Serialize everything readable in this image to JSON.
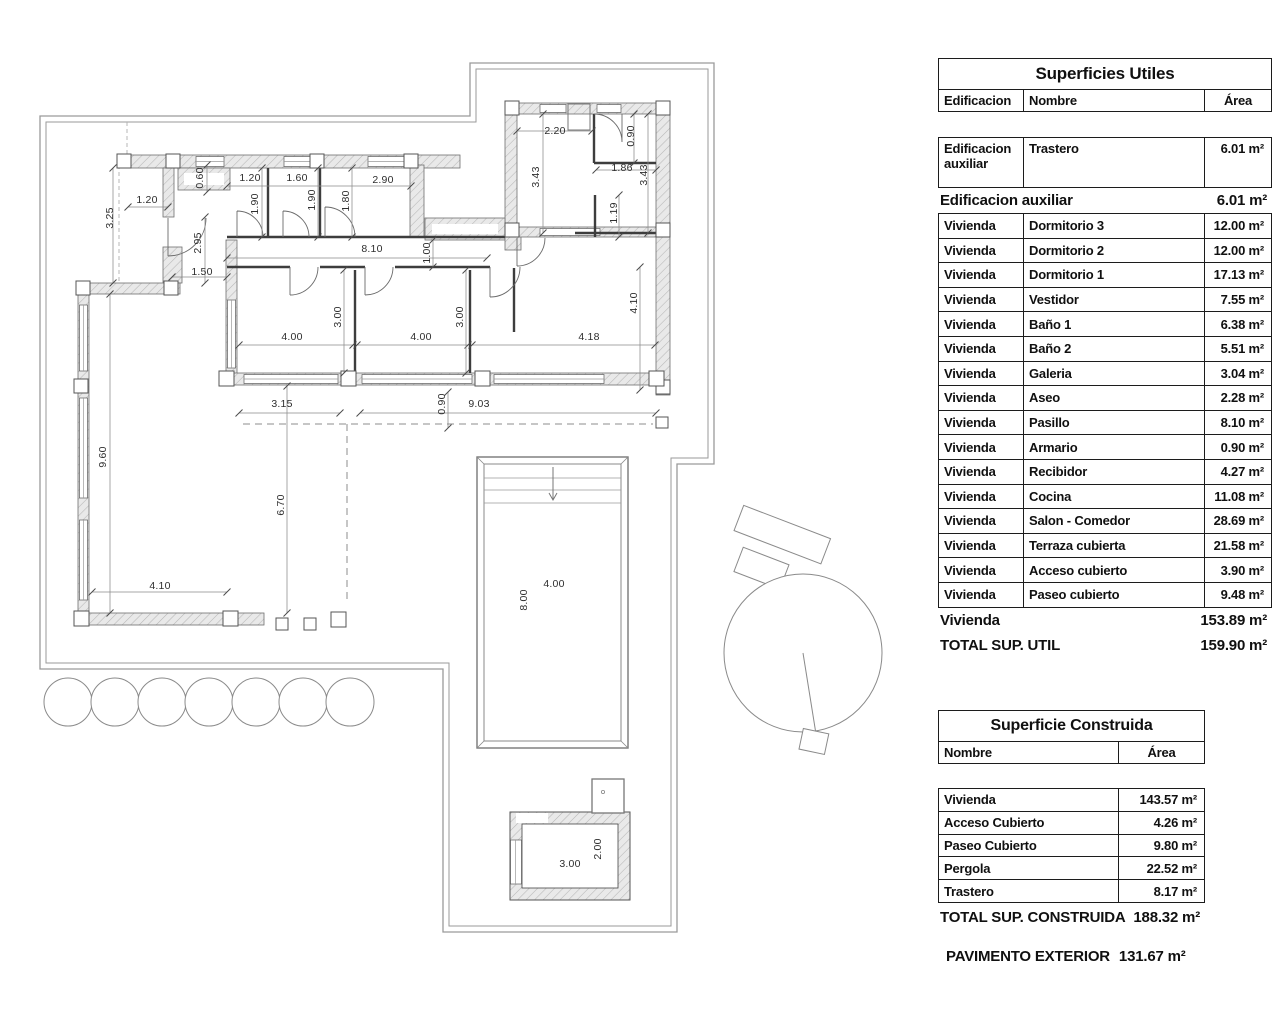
{
  "plan": {
    "dimensions": [
      {
        "t": "2.20",
        "x": 555,
        "y": 131
      },
      {
        "t": "0.90",
        "x": 631,
        "y": 136,
        "r": 1
      },
      {
        "t": "1.86",
        "x": 622,
        "y": 168
      },
      {
        "t": "3.43",
        "x": 536,
        "y": 177,
        "r": 1
      },
      {
        "t": "3.43",
        "x": 644,
        "y": 175,
        "r": 1
      },
      {
        "t": "1.19",
        "x": 614,
        "y": 213,
        "r": 1
      },
      {
        "t": "1.20",
        "x": 250,
        "y": 178
      },
      {
        "t": "1.60",
        "x": 297,
        "y": 178
      },
      {
        "t": "2.90",
        "x": 383,
        "y": 180
      },
      {
        "t": "0.60",
        "x": 200,
        "y": 178,
        "r": 1
      },
      {
        "t": "1.90",
        "x": 255,
        "y": 204,
        "r": 1
      },
      {
        "t": "1.90",
        "x": 312,
        "y": 200,
        "r": 1
      },
      {
        "t": "1.80",
        "x": 346,
        "y": 201,
        "r": 1
      },
      {
        "t": "1.20",
        "x": 147,
        "y": 200
      },
      {
        "t": "3.25",
        "x": 110,
        "y": 218,
        "r": 1
      },
      {
        "t": "2.95",
        "x": 198,
        "y": 243,
        "r": 1
      },
      {
        "t": "8.10",
        "x": 372,
        "y": 249
      },
      {
        "t": "1.00",
        "x": 427,
        "y": 253,
        "r": 1
      },
      {
        "t": "1.50",
        "x": 202,
        "y": 272
      },
      {
        "t": "4.00",
        "x": 292,
        "y": 337
      },
      {
        "t": "3.00",
        "x": 338,
        "y": 317,
        "r": 1
      },
      {
        "t": "4.00",
        "x": 421,
        "y": 337
      },
      {
        "t": "3.00",
        "x": 460,
        "y": 317,
        "r": 1
      },
      {
        "t": "4.18",
        "x": 589,
        "y": 337
      },
      {
        "t": "4.10",
        "x": 634,
        "y": 303,
        "r": 1
      },
      {
        "t": "3.15",
        "x": 282,
        "y": 404
      },
      {
        "t": "0.90",
        "x": 442,
        "y": 404,
        "r": 1
      },
      {
        "t": "9.03",
        "x": 479,
        "y": 404
      },
      {
        "t": "9.60",
        "x": 103,
        "y": 457,
        "r": 1
      },
      {
        "t": "6.70",
        "x": 281,
        "y": 505,
        "r": 1
      },
      {
        "t": "4.10",
        "x": 160,
        "y": 586
      },
      {
        "t": "4.00",
        "x": 554,
        "y": 584
      },
      {
        "t": "8.00",
        "x": 524,
        "y": 600,
        "r": 1
      },
      {
        "t": "3.00",
        "x": 570,
        "y": 864
      },
      {
        "t": "2.00",
        "x": 598,
        "y": 849,
        "r": 1
      }
    ]
  },
  "su": {
    "title": "Superficies Utiles",
    "headers": {
      "edificacion": "Edificacion",
      "nombre": "Nombre",
      "area": "Área"
    },
    "aux_row": {
      "e": "Edificacion auxiliar",
      "n": "Trastero",
      "a": "6.01 m²"
    },
    "aux_total": {
      "label": "Edificacion auxiliar",
      "value": "6.01 m²"
    },
    "rows": [
      {
        "e": "Vivienda",
        "n": "Dormitorio 3",
        "a": "12.00 m²"
      },
      {
        "e": "Vivienda",
        "n": "Dormitorio 2",
        "a": "12.00 m²"
      },
      {
        "e": "Vivienda",
        "n": "Dormitorio 1",
        "a": "17.13 m²"
      },
      {
        "e": "Vivienda",
        "n": "Vestidor",
        "a": "7.55 m²"
      },
      {
        "e": "Vivienda",
        "n": "Baño 1",
        "a": "6.38 m²"
      },
      {
        "e": "Vivienda",
        "n": "Baño 2",
        "a": "5.51 m²"
      },
      {
        "e": "Vivienda",
        "n": "Galeria",
        "a": "3.04 m²"
      },
      {
        "e": "Vivienda",
        "n": "Aseo",
        "a": "2.28 m²"
      },
      {
        "e": "Vivienda",
        "n": "Pasillo",
        "a": "8.10 m²"
      },
      {
        "e": "Vivienda",
        "n": "Armario",
        "a": "0.90 m²"
      },
      {
        "e": "Vivienda",
        "n": "Recibidor",
        "a": "4.27 m²"
      },
      {
        "e": "Vivienda",
        "n": "Cocina",
        "a": "11.08 m²"
      },
      {
        "e": "Vivienda",
        "n": "Salon - Comedor",
        "a": "28.69 m²"
      },
      {
        "e": "Vivienda",
        "n": "Terraza cubierta",
        "a": "21.58 m²"
      },
      {
        "e": "Vivienda",
        "n": "Acceso cubierto",
        "a": "3.90 m²"
      },
      {
        "e": "Vivienda",
        "n": "Paseo cubierto",
        "a": "9.48 m²"
      }
    ],
    "viv_total": {
      "label": "Vivienda",
      "value": "153.89 m²"
    },
    "grand_total": {
      "label": "TOTAL SUP. UTIL",
      "value": "159.90 m²"
    }
  },
  "sc": {
    "title": "Superficie Construida",
    "headers": {
      "nombre": "Nombre",
      "area": "Área"
    },
    "rows": [
      {
        "n": "Vivienda",
        "a": "143.57 m²"
      },
      {
        "n": "Acceso Cubierto",
        "a": "4.26 m²"
      },
      {
        "n": "Paseo Cubierto",
        "a": "9.80 m²"
      },
      {
        "n": "Pergola",
        "a": "22.52 m²"
      },
      {
        "n": "Trastero",
        "a": "8.17 m²"
      }
    ],
    "total": {
      "label": "TOTAL SUP. CONSTRUIDA",
      "value": "188.32 m²"
    },
    "pavimento": {
      "label": "PAVIMENTO EXTERIOR",
      "value": "131.67 m²"
    }
  }
}
